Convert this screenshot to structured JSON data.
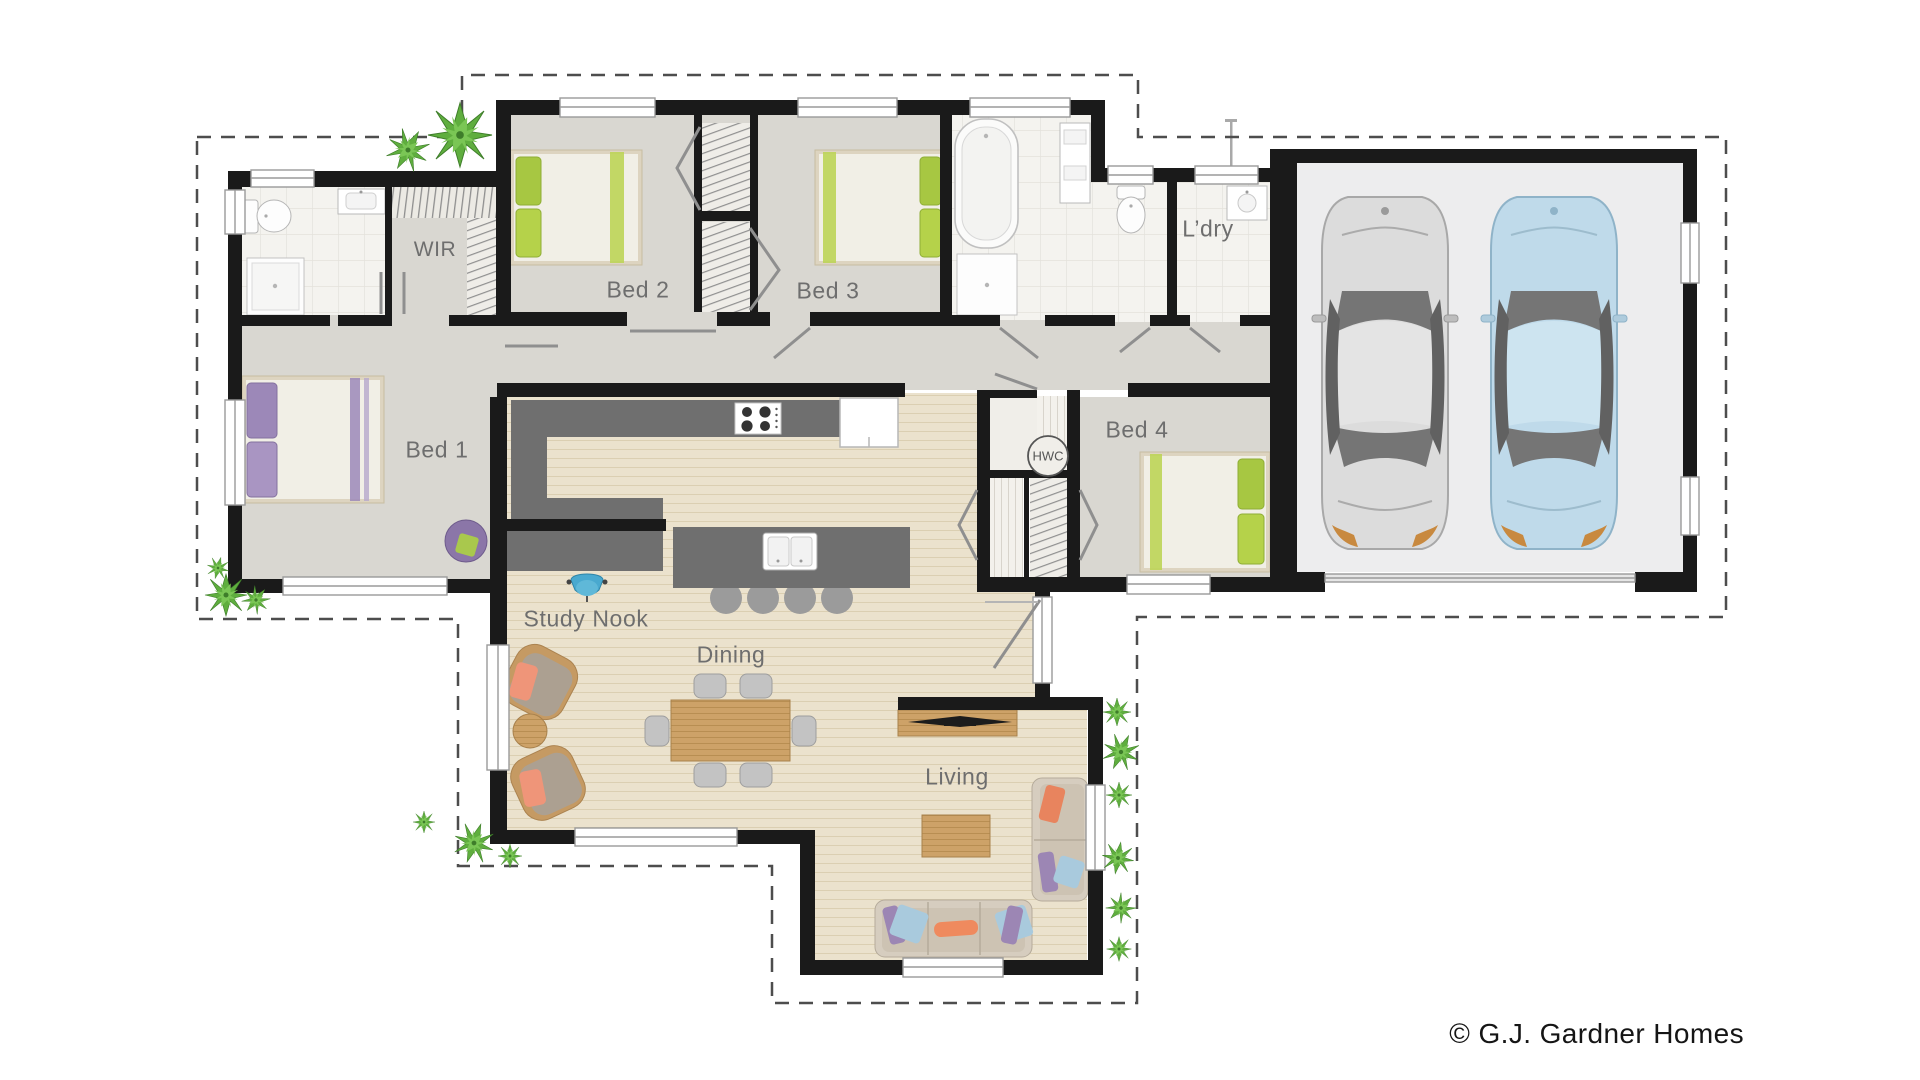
{
  "plan": {
    "watermark": "© G.J. Gardner Homes",
    "rooms": [
      {
        "id": "wir",
        "label": "WIR"
      },
      {
        "id": "bed2",
        "label": "Bed 2"
      },
      {
        "id": "bed3",
        "label": "Bed 3"
      },
      {
        "id": "ldry",
        "label": "L’dry"
      },
      {
        "id": "bed1",
        "label": "Bed 1"
      },
      {
        "id": "bed4",
        "label": "Bed 4"
      },
      {
        "id": "study",
        "label": "Study Nook"
      },
      {
        "id": "dining",
        "label": "Dining"
      },
      {
        "id": "living",
        "label": "Living"
      },
      {
        "id": "hwc",
        "label": "HWC"
      }
    ],
    "colors": {
      "wall": "#1a1a1a",
      "wing_floor": "#d9d7d1",
      "wood_floor": "#ebe2cd",
      "tile_floor": "#f4f3ef",
      "garage_floor": "#ededee",
      "counter": "#6f6f6f",
      "accent_green": "#a7c742",
      "accent_purple": "#9c88b8",
      "plant_green": "#5fae3e",
      "car_silver": "#dcdcdc",
      "car_blue": "#bfdaea",
      "boundary": "#4d4d4d"
    }
  }
}
